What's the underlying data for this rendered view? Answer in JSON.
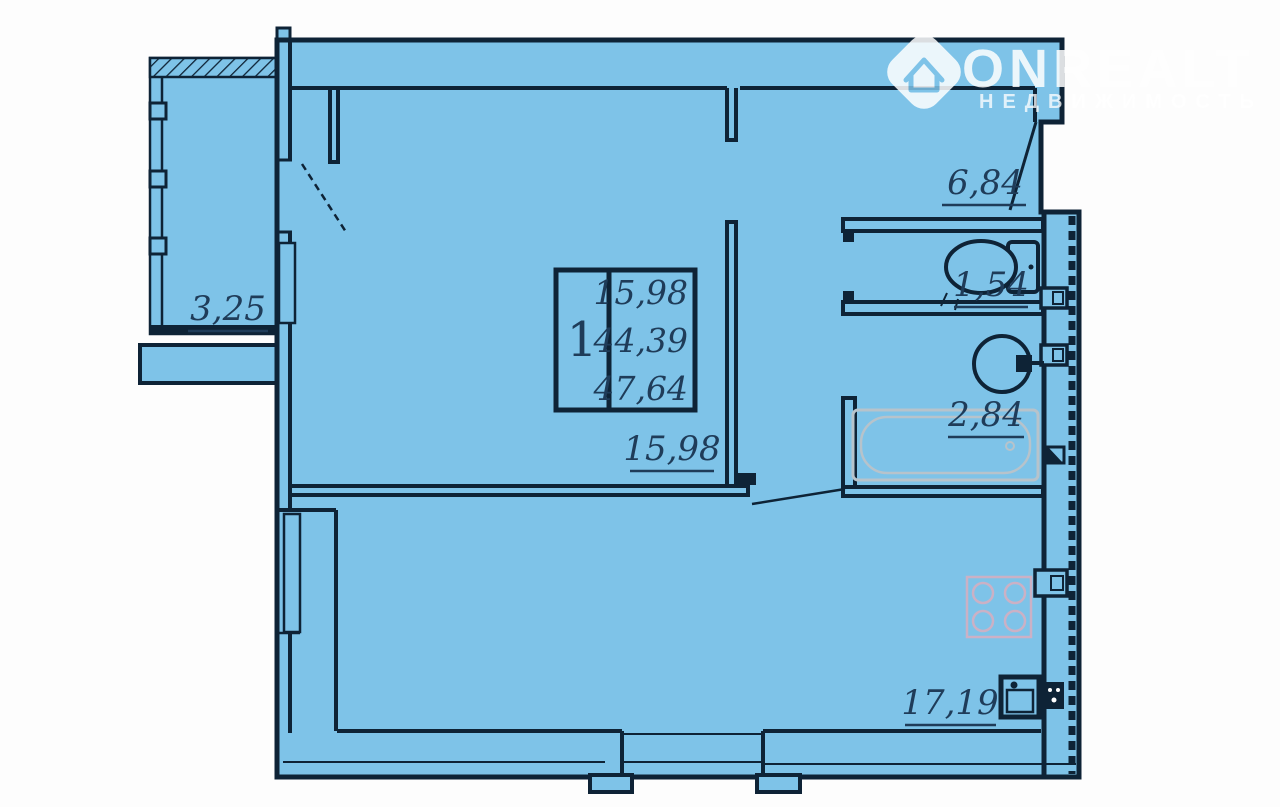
{
  "title": "Floor plan — 1-room apartment",
  "colors": {
    "background": "#fdfdfd",
    "plan_fill": "#7ec3e8",
    "wall": "#0e2336",
    "label_text": "#1f3c59",
    "bathtub_outline": "#b7c3cb",
    "stove_outline": "#d9aec0",
    "logo": "#ffffff"
  },
  "labels": {
    "balcony": "3,25",
    "hallway": "6,84",
    "wc": "1,54",
    "bathroom": "2,84",
    "living_room": "15,98",
    "kitchen": "17,19"
  },
  "info_box": {
    "room_count": "1",
    "living_area": "15,98",
    "usable_area": "44,39",
    "total_area": "47,64"
  },
  "logo": {
    "brand": "ONREALT",
    "subtitle": "НЕДВИЖИМОСТЬ",
    "icon": "house-icon"
  }
}
